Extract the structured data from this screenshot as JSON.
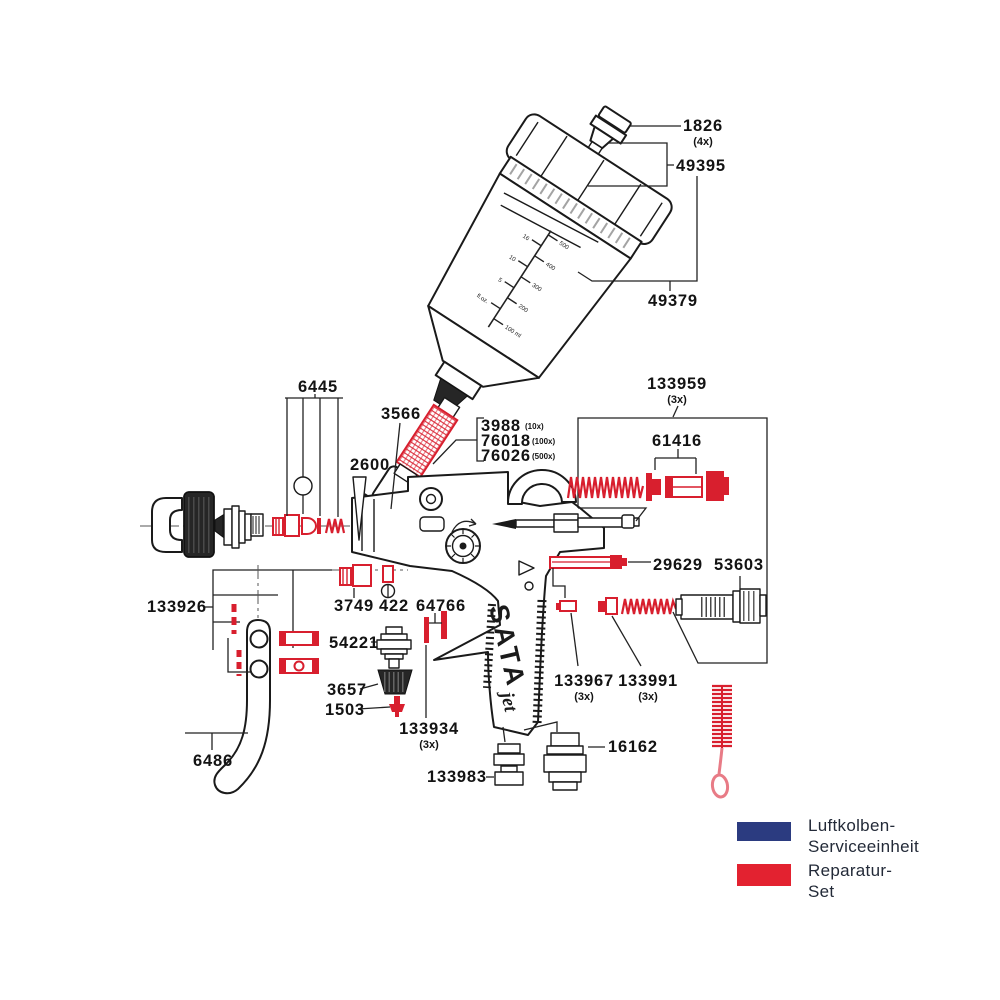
{
  "colors": {
    "accent_red": "#d81f2e",
    "legend_blue": "#2b3b80",
    "legend_red": "#e32230",
    "line_black": "#1a1a1a"
  },
  "brand": {
    "logo_main": "SATA",
    "logo_sub": "jet"
  },
  "parts": {
    "p1826": {
      "number": "1826",
      "qty": "(4x)"
    },
    "p49395": {
      "number": "49395"
    },
    "p49379": {
      "number": "49379"
    },
    "p6445": {
      "number": "6445"
    },
    "p3566": {
      "number": "3566"
    },
    "p3988": {
      "number": "3988",
      "qty": "(10x)"
    },
    "p76018": {
      "number": "76018",
      "qty": "(100x)"
    },
    "p76026": {
      "number": "76026",
      "qty": "(500x)"
    },
    "p2600": {
      "number": "2600"
    },
    "p133959": {
      "number": "133959",
      "qty": "(3x)"
    },
    "p61416": {
      "number": "61416"
    },
    "p29629": {
      "number": "29629"
    },
    "p53603": {
      "number": "53603"
    },
    "p3749": {
      "number": "3749"
    },
    "p422": {
      "number": "422"
    },
    "p64766": {
      "number": "64766"
    },
    "p133926": {
      "number": "133926"
    },
    "p54221": {
      "number": "54221"
    },
    "p3657": {
      "number": "3657"
    },
    "p1503": {
      "number": "1503"
    },
    "p133934": {
      "number": "133934",
      "qty": "(3x)"
    },
    "p6486": {
      "number": "6486"
    },
    "p133983": {
      "number": "133983"
    },
    "p16162": {
      "number": "16162"
    },
    "p133967": {
      "number": "133967",
      "qty": "(3x)"
    },
    "p133991": {
      "number": "133991",
      "qty": "(3x)"
    }
  },
  "legend": {
    "items": [
      {
        "line1": "Luftkolben-",
        "line2": "Serviceeinheit",
        "color": "#2b3b80"
      },
      {
        "line1": "Reparatur-",
        "line2": "Set",
        "color": "#e32230"
      }
    ]
  },
  "cup_scale": {
    "right_labels": [
      "500",
      "400",
      "300",
      "200",
      "100 ml"
    ],
    "left_labels": [
      "16",
      "10",
      "5",
      "fl.oz."
    ]
  }
}
